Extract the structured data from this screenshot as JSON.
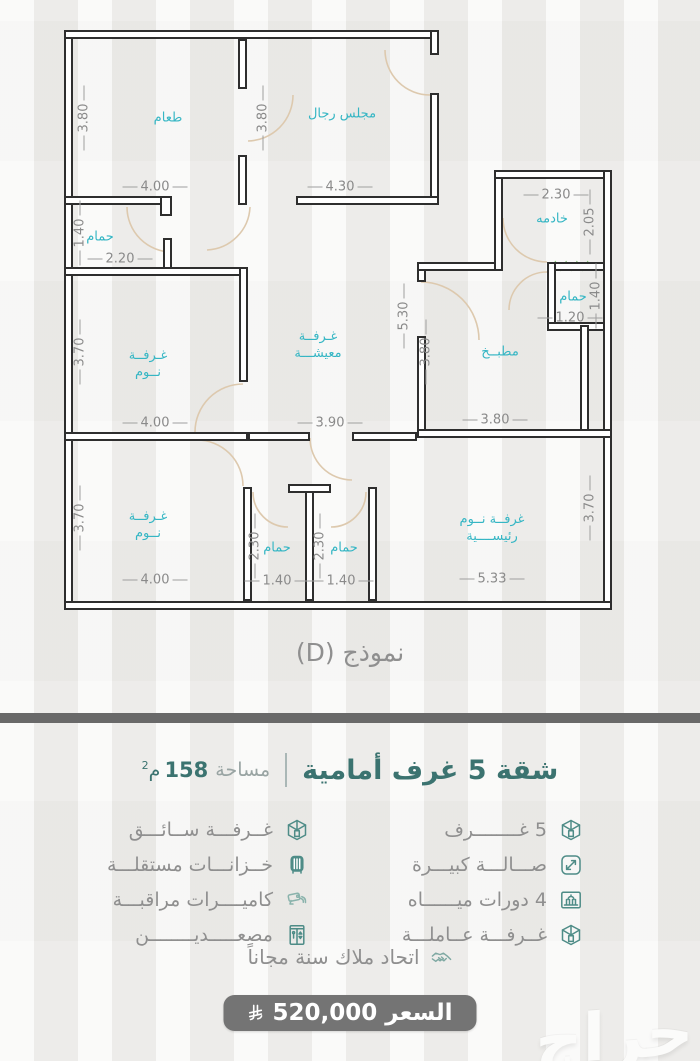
{
  "colors": {
    "accent_teal": "#3b7370",
    "room_label_cyan": "#35b6c4",
    "wall": "#2e2e2e",
    "divider_bar": "#696969",
    "price_button": "#747474",
    "icon_teal": "#4e8c87"
  },
  "floorplan": {
    "caption": "نموذج (D)",
    "walls": [
      [
        64,
        30,
        9,
        580
      ],
      [
        64,
        30,
        375,
        9
      ],
      [
        430,
        30,
        9,
        25
      ],
      [
        430,
        93,
        9,
        112
      ],
      [
        238,
        39,
        9,
        50
      ],
      [
        238,
        155,
        9,
        50
      ],
      [
        64,
        196,
        108,
        9
      ],
      [
        160,
        196,
        12,
        20
      ],
      [
        296,
        196,
        143,
        9
      ],
      [
        163,
        238,
        9,
        38
      ],
      [
        64,
        267,
        184,
        9
      ],
      [
        239,
        267,
        9,
        115
      ],
      [
        64,
        432,
        184,
        9
      ],
      [
        248,
        432,
        62,
        9
      ],
      [
        352,
        432,
        65,
        9
      ],
      [
        417,
        262,
        9,
        20
      ],
      [
        417,
        336,
        9,
        96
      ],
      [
        417,
        262,
        86,
        9
      ],
      [
        494,
        170,
        9,
        101
      ],
      [
        494,
        170,
        118,
        9
      ],
      [
        547,
        262,
        65,
        9
      ],
      [
        547,
        262,
        9,
        69
      ],
      [
        547,
        322,
        65,
        9
      ],
      [
        580,
        325,
        9,
        107
      ],
      [
        603,
        170,
        9,
        440
      ],
      [
        417,
        429,
        195,
        9
      ],
      [
        368,
        487,
        9,
        114
      ],
      [
        243,
        487,
        9,
        114
      ],
      [
        305,
        487,
        9,
        114
      ],
      [
        288,
        484,
        43,
        9
      ],
      [
        64,
        601,
        548,
        9
      ]
    ],
    "door_arcs": [
      "M127 207 A45 45 0 0 0 172 252",
      "M250 207 A45 45 0 0 1 207 250",
      "M385 50 A45 45 0 0 0 430 95",
      "M293 95 A46 46 0 0 1 248 141",
      "M503 218 A44 44 0 0 0 547 262",
      "M421 282 A58 58 0 0 1 479 340",
      "M243 384 A48 48 0 0 0 195 432",
      "M197 440 A46 46 0 0 1 243 486",
      "M310 438 A42 42 0 0 0 352 480",
      "M253 492 A35 35 0 0 0 288 527",
      "M366 492 A35 35 0 0 1 331 527",
      "M547 272 A38 38 0 0 0 509 310"
    ],
    "window_marker": {
      "x": 550,
      "y": 262,
      "w": 43,
      "h": 8
    },
    "rooms": [
      {
        "lines": [
          "طعام"
        ],
        "x": 168,
        "y": 118
      },
      {
        "lines": [
          "مجلس رجال"
        ],
        "x": 342,
        "y": 114
      },
      {
        "lines": [
          "حمام"
        ],
        "x": 100,
        "y": 237
      },
      {
        "lines": [
          "خادمه"
        ],
        "x": 552,
        "y": 219
      },
      {
        "lines": [
          "غـرفــة",
          "نــوم"
        ],
        "x": 148,
        "y": 364
      },
      {
        "lines": [
          "غـرفــة",
          "معيشـــة"
        ],
        "x": 318,
        "y": 345
      },
      {
        "lines": [
          "مطبــخ"
        ],
        "x": 500,
        "y": 352
      },
      {
        "lines": [
          "حمام"
        ],
        "x": 573,
        "y": 297
      },
      {
        "lines": [
          "غـرفــة",
          "نــوم"
        ],
        "x": 148,
        "y": 525
      },
      {
        "lines": [
          "حمام"
        ],
        "x": 277,
        "y": 548
      },
      {
        "lines": [
          "حمام"
        ],
        "x": 344,
        "y": 548
      },
      {
        "lines": [
          "غرفــة نــوم",
          "رئيســــية"
        ],
        "x": 492,
        "y": 528
      }
    ],
    "dimensions": [
      {
        "text": "3.80",
        "x": 84,
        "y": 118,
        "v": true
      },
      {
        "text": "3.80",
        "x": 263,
        "y": 118,
        "v": true
      },
      {
        "text": "4.00",
        "x": 155,
        "y": 187,
        "v": false
      },
      {
        "text": "4.30",
        "x": 340,
        "y": 187,
        "v": false
      },
      {
        "text": "2.30",
        "x": 556,
        "y": 195,
        "v": false
      },
      {
        "text": "2.05",
        "x": 590,
        "y": 222,
        "v": true
      },
      {
        "text": "1.40",
        "x": 80,
        "y": 233,
        "v": true
      },
      {
        "text": "2.20",
        "x": 120,
        "y": 259,
        "v": false
      },
      {
        "text": "3.70",
        "x": 80,
        "y": 352,
        "v": true
      },
      {
        "text": "5.30",
        "x": 404,
        "y": 316,
        "v": true
      },
      {
        "text": "3.80",
        "x": 426,
        "y": 352,
        "v": true
      },
      {
        "text": "1.40",
        "x": 596,
        "y": 296,
        "v": true
      },
      {
        "text": "1.20",
        "x": 570,
        "y": 318,
        "v": false
      },
      {
        "text": "4.00",
        "x": 155,
        "y": 423,
        "v": false
      },
      {
        "text": "3.90",
        "x": 330,
        "y": 423,
        "v": false
      },
      {
        "text": "3.80",
        "x": 495,
        "y": 420,
        "v": false
      },
      {
        "text": "3.70",
        "x": 80,
        "y": 518,
        "v": true
      },
      {
        "text": "2.30",
        "x": 255,
        "y": 546,
        "v": true
      },
      {
        "text": "2.30",
        "x": 320,
        "y": 546,
        "v": true
      },
      {
        "text": "3.70",
        "x": 590,
        "y": 508,
        "v": true
      },
      {
        "text": "4.00",
        "x": 155,
        "y": 580,
        "v": false
      },
      {
        "text": "1.40",
        "x": 277,
        "y": 581,
        "v": false
      },
      {
        "text": "1.40",
        "x": 341,
        "y": 581,
        "v": false
      },
      {
        "text": "5.33",
        "x": 492,
        "y": 579,
        "v": false
      }
    ]
  },
  "info": {
    "title": "شقة 5 غرف أمامية",
    "area_label": "مساحة",
    "area_value": "158",
    "area_unit": "م",
    "area_sup": "2",
    "features_right": [
      {
        "icon": "room-cube-icon",
        "label": "5 غــــــــرف"
      },
      {
        "icon": "expand-icon",
        "label": "صـــالـــة كبيـــرة"
      },
      {
        "icon": "building-icon",
        "label": "4 دورات ميــــــاه"
      },
      {
        "icon": "room-cube-icon",
        "label": "غــرفـــة عــاملـــة"
      }
    ],
    "features_left": [
      {
        "icon": "room-cube-icon",
        "label": "غــرفـــة ســائـــق"
      },
      {
        "icon": "tank-icon",
        "label": "خــزانـــات مستقلـــة"
      },
      {
        "icon": "camera-icon",
        "label": "كاميــــرات مراقبـــة"
      },
      {
        "icon": "elevator-icon",
        "label": "مصعـــــديــــــــن"
      }
    ],
    "union_note": "اتحاد ملاك سنة مجاناً",
    "price_label": "السعر",
    "price_value": "520,000"
  },
  "watermark": "حراج"
}
